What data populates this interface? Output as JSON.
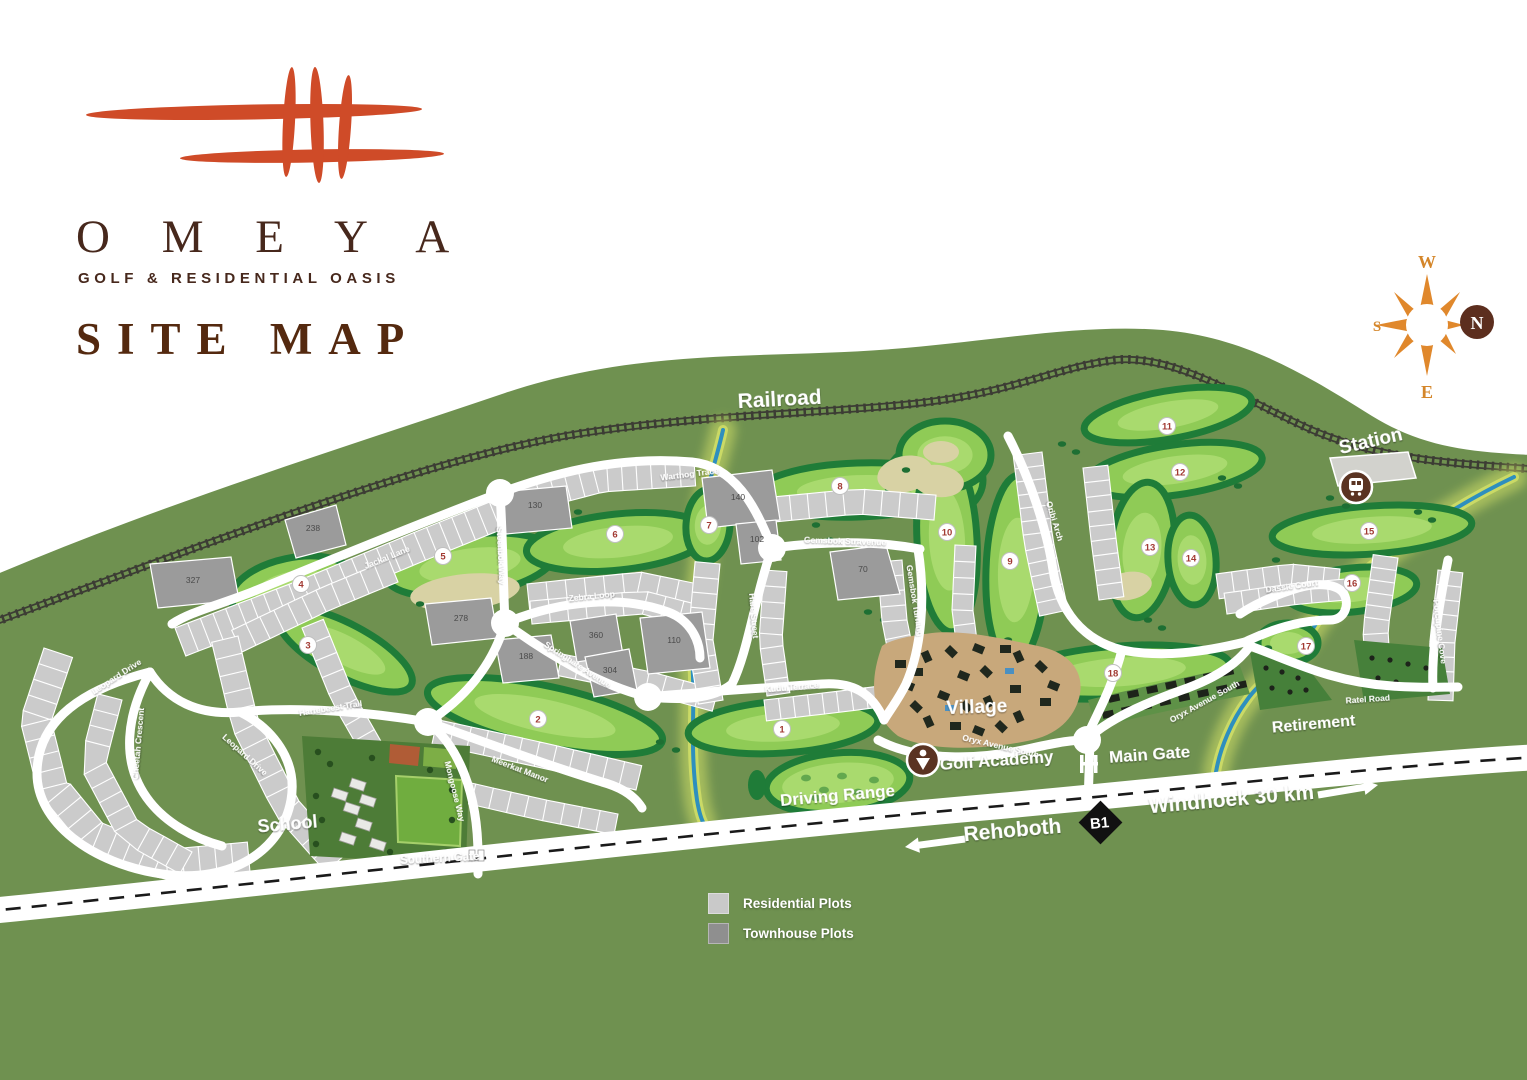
{
  "logo": {
    "title": "O M E Y A",
    "subtitle": "GOLF & RESIDENTIAL OASIS",
    "heading": "SITE MAP"
  },
  "compass": {
    "top": "W",
    "right": "N",
    "bottom": "E",
    "left": "S"
  },
  "legend": {
    "items": [
      {
        "label": "Residential Plots",
        "color": "#c9c9c9"
      },
      {
        "label": "Townhouse Plots",
        "color": "#8f8f8f"
      }
    ]
  },
  "highway": {
    "left_destination": "Rehoboth",
    "route_badge": "B1",
    "right_destination": "Windhoek 30 km"
  },
  "colors": {
    "brand_orange": "#cf4b28",
    "brand_brown": "#47281c",
    "land_green": "#6f9150",
    "fairway_green": "#8fcb56",
    "river_blue": "#2e8fbe",
    "residential_gray": "#cbcbcb",
    "townhouse_gray": "#9b9b9b"
  },
  "map": {
    "place_labels": [
      {
        "id": "railroad",
        "text": "Railroad",
        "x": 780,
        "y": 406,
        "rot": -3,
        "size": 21
      },
      {
        "id": "station",
        "text": "Station",
        "x": 1372,
        "y": 447,
        "rot": -13,
        "size": 19
      },
      {
        "id": "village",
        "text": "Village",
        "x": 977,
        "y": 713,
        "rot": -2,
        "size": 19
      },
      {
        "id": "golf-academy",
        "text": "Golf Academy",
        "x": 997,
        "y": 766,
        "rot": -4,
        "size": 17
      },
      {
        "id": "driving-range",
        "text": "Driving Range",
        "x": 838,
        "y": 801,
        "rot": -5,
        "size": 17
      },
      {
        "id": "main-gate",
        "text": "Main Gate",
        "x": 1150,
        "y": 760,
        "rot": -4,
        "size": 17
      },
      {
        "id": "school",
        "text": "School",
        "x": 288,
        "y": 830,
        "rot": -5,
        "size": 18
      },
      {
        "id": "southern-gate",
        "text": "Southern Gate",
        "x": 440,
        "y": 862,
        "rot": -3,
        "size": 11.5
      },
      {
        "id": "retirement",
        "text": "Retirement",
        "x": 1314,
        "y": 729,
        "rot": -5,
        "size": 16
      }
    ],
    "street_labels": [
      {
        "text": "Warthog Trace",
        "x": 690,
        "y": 477,
        "rot": -7
      },
      {
        "text": "Jackal Lane",
        "x": 388,
        "y": 560,
        "rot": -22
      },
      {
        "text": "Steenbok Way",
        "x": 498,
        "y": 556,
        "rot": 87
      },
      {
        "text": "Zebra Loop",
        "x": 592,
        "y": 599,
        "rot": -6
      },
      {
        "text": "Springhare Avenue",
        "x": 576,
        "y": 667,
        "rot": 33
      },
      {
        "text": "Hare Street",
        "x": 751,
        "y": 616,
        "rot": 85
      },
      {
        "text": "Gemsbok Stravenue",
        "x": 845,
        "y": 544,
        "rot": 2
      },
      {
        "text": "Gemsbok Turning",
        "x": 912,
        "y": 601,
        "rot": 81
      },
      {
        "text": "Kudu Terrace",
        "x": 792,
        "y": 690,
        "rot": -5
      },
      {
        "text": "Oribi Arch",
        "x": 1052,
        "y": 522,
        "rot": 73
      },
      {
        "text": "Dassie Court",
        "x": 1292,
        "y": 589,
        "rot": -8
      },
      {
        "text": "Porcupine Cove",
        "x": 1437,
        "y": 632,
        "rot": 83
      },
      {
        "text": "Ratel Road",
        "x": 1368,
        "y": 702,
        "rot": -4
      },
      {
        "text": "Oryx Avenue South",
        "x": 1000,
        "y": 749,
        "rot": 13
      },
      {
        "text": "Oryx Avenue South",
        "x": 1206,
        "y": 704,
        "rot": -29
      },
      {
        "text": "Leopard Drive",
        "x": 118,
        "y": 679,
        "rot": -33
      },
      {
        "text": "Leopard Drive",
        "x": 243,
        "y": 757,
        "rot": 42
      },
      {
        "text": "Cheetah Crescent",
        "x": 141,
        "y": 744,
        "rot": -85
      },
      {
        "text": "Hartebeest Trail",
        "x": 331,
        "y": 711,
        "rot": -9
      },
      {
        "text": "Meerkat Manor",
        "x": 519,
        "y": 772,
        "rot": 21
      },
      {
        "text": "Mongoose Way",
        "x": 452,
        "y": 792,
        "rot": 76
      }
    ],
    "plot_labels": [
      {
        "text": "140",
        "x": 738,
        "y": 500
      },
      {
        "text": "130",
        "x": 535,
        "y": 508
      },
      {
        "text": "110",
        "x": 674,
        "y": 643
      },
      {
        "text": "102",
        "x": 757,
        "y": 542
      },
      {
        "text": "70",
        "x": 863,
        "y": 572
      },
      {
        "text": "188",
        "x": 526,
        "y": 659
      },
      {
        "text": "238",
        "x": 313,
        "y": 531
      },
      {
        "text": "278",
        "x": 461,
        "y": 621
      },
      {
        "text": "327",
        "x": 193,
        "y": 583
      },
      {
        "text": "360",
        "x": 596,
        "y": 638
      },
      {
        "text": "304",
        "x": 610,
        "y": 673
      }
    ],
    "golf_holes": [
      {
        "n": "1",
        "x": 782,
        "y": 729
      },
      {
        "n": "2",
        "x": 538,
        "y": 719
      },
      {
        "n": "3",
        "x": 308,
        "y": 645
      },
      {
        "n": "4",
        "x": 301,
        "y": 584
      },
      {
        "n": "5",
        "x": 443,
        "y": 556
      },
      {
        "n": "6",
        "x": 615,
        "y": 534
      },
      {
        "n": "7",
        "x": 709,
        "y": 525
      },
      {
        "n": "8",
        "x": 840,
        "y": 486
      },
      {
        "n": "9",
        "x": 1010,
        "y": 561
      },
      {
        "n": "10",
        "x": 947,
        "y": 532
      },
      {
        "n": "11",
        "x": 1167,
        "y": 426
      },
      {
        "n": "12",
        "x": 1180,
        "y": 472
      },
      {
        "n": "13",
        "x": 1150,
        "y": 547
      },
      {
        "n": "14",
        "x": 1191,
        "y": 558
      },
      {
        "n": "15",
        "x": 1369,
        "y": 531
      },
      {
        "n": "16",
        "x": 1352,
        "y": 583
      },
      {
        "n": "17",
        "x": 1306,
        "y": 646
      },
      {
        "n": "18",
        "x": 1113,
        "y": 673
      }
    ]
  }
}
